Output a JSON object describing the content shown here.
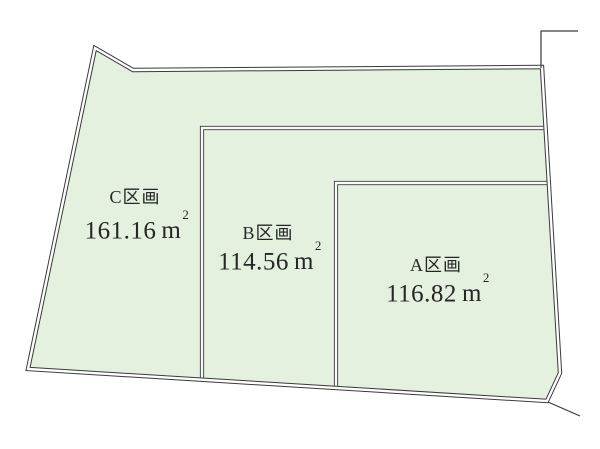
{
  "diagram": {
    "title": "land-parcel-layout",
    "parcels": [
      {
        "name": "C区画",
        "area_value": "161.16",
        "area_unit": "m",
        "area_exponent": "2"
      },
      {
        "name": "B区画",
        "area_value": "114.56",
        "area_unit": "m",
        "area_exponent": "2"
      },
      {
        "name": "A区画",
        "area_value": "116.82",
        "area_unit": "m",
        "area_exponent": "2"
      }
    ]
  },
  "geometry": {
    "outer_polygon": "95,48 133,70 542,67 560,373 547,401 28,369",
    "parcel_b_boundary": "202,380 202,128 546,128",
    "parcel_a_boundary": "336,388 336,183 549,183",
    "tick_top_right": "541,68 541,31 578,31",
    "tick_bottom_right": "548,402 580,416"
  },
  "colors": {
    "background": "#ffffff",
    "parcel_fill": "#e4f1df",
    "boundary_line": "#3a3a3a",
    "label_text": "#262626"
  }
}
